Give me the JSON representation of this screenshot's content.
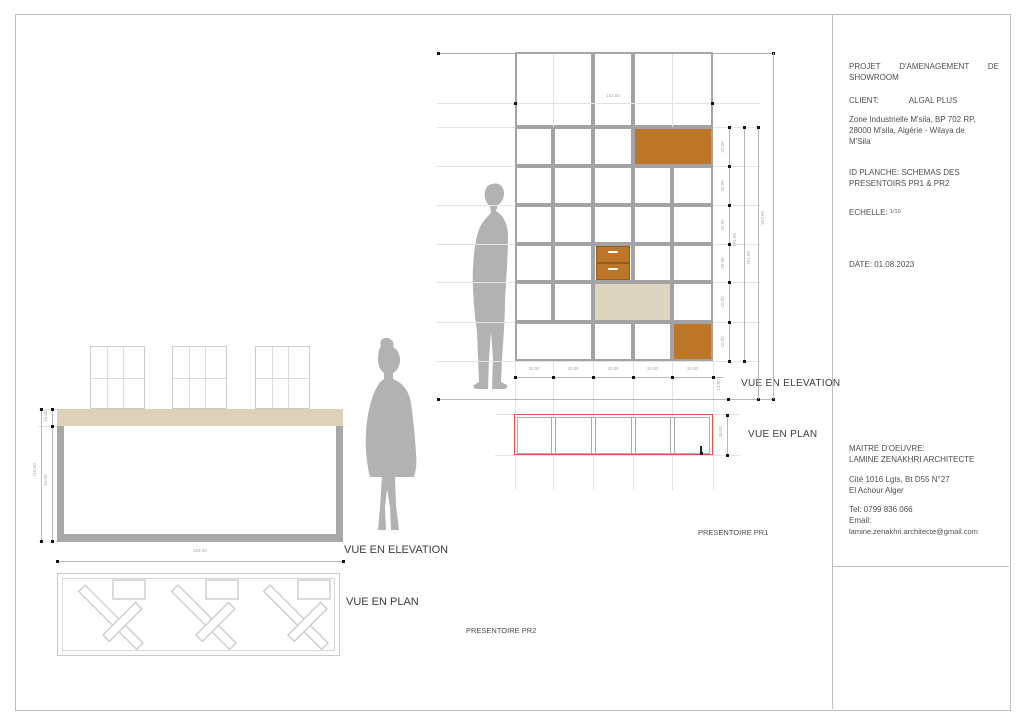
{
  "title_block": {
    "project_line1": "PROJET D'AMENAGEMENT DE",
    "project_line2": "SHOWROOM",
    "client_label": "CLIENT:",
    "client_name": "ALGAL PLUS",
    "address_line1": "Zone Industrielle M'sila, BP 702 RP,",
    "address_line2": "28000 M'sila, Algérie - Wilaya de",
    "address_line3": "M'Sila",
    "sheet_id_line1": "ID PLANCHE: SCHEMAS DES",
    "sheet_id_line2": "PRESENTOIRS PR1 & PR2",
    "scale_label": "ECHELLE:",
    "scale_value": "1/10",
    "date": "DATE: 01.08.2023",
    "moe_line1": "MAITRE D'OEUVRE:",
    "moe_line2": "LAMINE ZENAKHRI ARCHITECTE",
    "moe_address1": "Cité 1016 Lgts, Bt D55 N°27",
    "moe_address2": "El Achour Alger",
    "phone": "Tel: 0799 836 066",
    "email_label": "Email:",
    "email": "lamine.zenakhri.architecte@gmail.com"
  },
  "labels": {
    "pr1_elevation": "VUE EN ELEVATION",
    "pr1_plan": "VUE EN PLAN",
    "pr1_name": "PRESENTOIRE PR1",
    "pr2_elevation": "VUE EN ELEVATION",
    "pr2_plan": "VUE EN PLAN",
    "pr2_name": "PRESENTOIRE PR2"
  },
  "colors": {
    "accent_brown": "#bd7528",
    "accent_beige": "#ded5c1",
    "tabletop": "#ddd2b9",
    "frame_gray": "#a8a8a8",
    "plan_outline_red": "#e0544a",
    "silhouette": "#b2b2b2",
    "cell_border": "#a3a3a3",
    "dim_line": "#b8b8b8",
    "construction": "#e4e4e4"
  },
  "pr1": {
    "grid": {
      "left": 515,
      "top": 52,
      "col_widths": [
        38,
        40,
        40,
        39,
        41
      ],
      "rows": [
        {
          "h": 75,
          "cells": [
            {
              "c": 2
            },
            {
              "c": 1,
              "dim": true
            },
            {
              "c": 2
            }
          ]
        },
        {
          "h": 39,
          "cells": [
            {
              "c": 1
            },
            {
              "c": 1
            },
            {
              "c": 1
            },
            {
              "c": 2,
              "fill": "brown"
            }
          ]
        },
        {
          "h": 39,
          "cells": [
            {
              "c": 1
            },
            {
              "c": 1
            },
            {
              "c": 1
            },
            {
              "c": 1
            },
            {
              "c": 1
            }
          ]
        },
        {
          "h": 39,
          "cells": [
            {
              "c": 1
            },
            {
              "c": 1
            },
            {
              "c": 1
            },
            {
              "c": 1
            },
            {
              "c": 1
            }
          ]
        },
        {
          "h": 38,
          "cells": [
            {
              "c": 1
            },
            {
              "c": 1
            },
            {
              "c": 1,
              "drawers": true
            },
            {
              "c": 1
            },
            {
              "c": 1
            }
          ]
        },
        {
          "h": 40,
          "cells": [
            {
              "c": 1
            },
            {
              "c": 1
            },
            {
              "c": 2,
              "fill": "beige"
            },
            {
              "c": 1
            }
          ]
        },
        {
          "h": 39,
          "cells": [
            {
              "c": 2
            },
            {
              "c": 1
            },
            {
              "c": 1
            },
            {
              "c": 1,
              "fill": "brown"
            }
          ]
        }
      ]
    },
    "dims": {
      "width_top": "162.00",
      "bottom": [
        "32.00",
        "32.00",
        "32.00",
        "32.00",
        "32.00"
      ],
      "bottom_end": "12.00",
      "right_rows": [
        "32.00",
        "32.00",
        "32.00",
        "32.00",
        "32.00",
        "32.00"
      ],
      "right_mid": "194.00",
      "right_total": "191.00",
      "right_overall": "253.00",
      "plan_depth": "30.00"
    }
  },
  "pr2": {
    "dims": {
      "width": "234.00",
      "top_height": "16.00",
      "leg_height": "94.00",
      "total_height": "110.00"
    }
  }
}
